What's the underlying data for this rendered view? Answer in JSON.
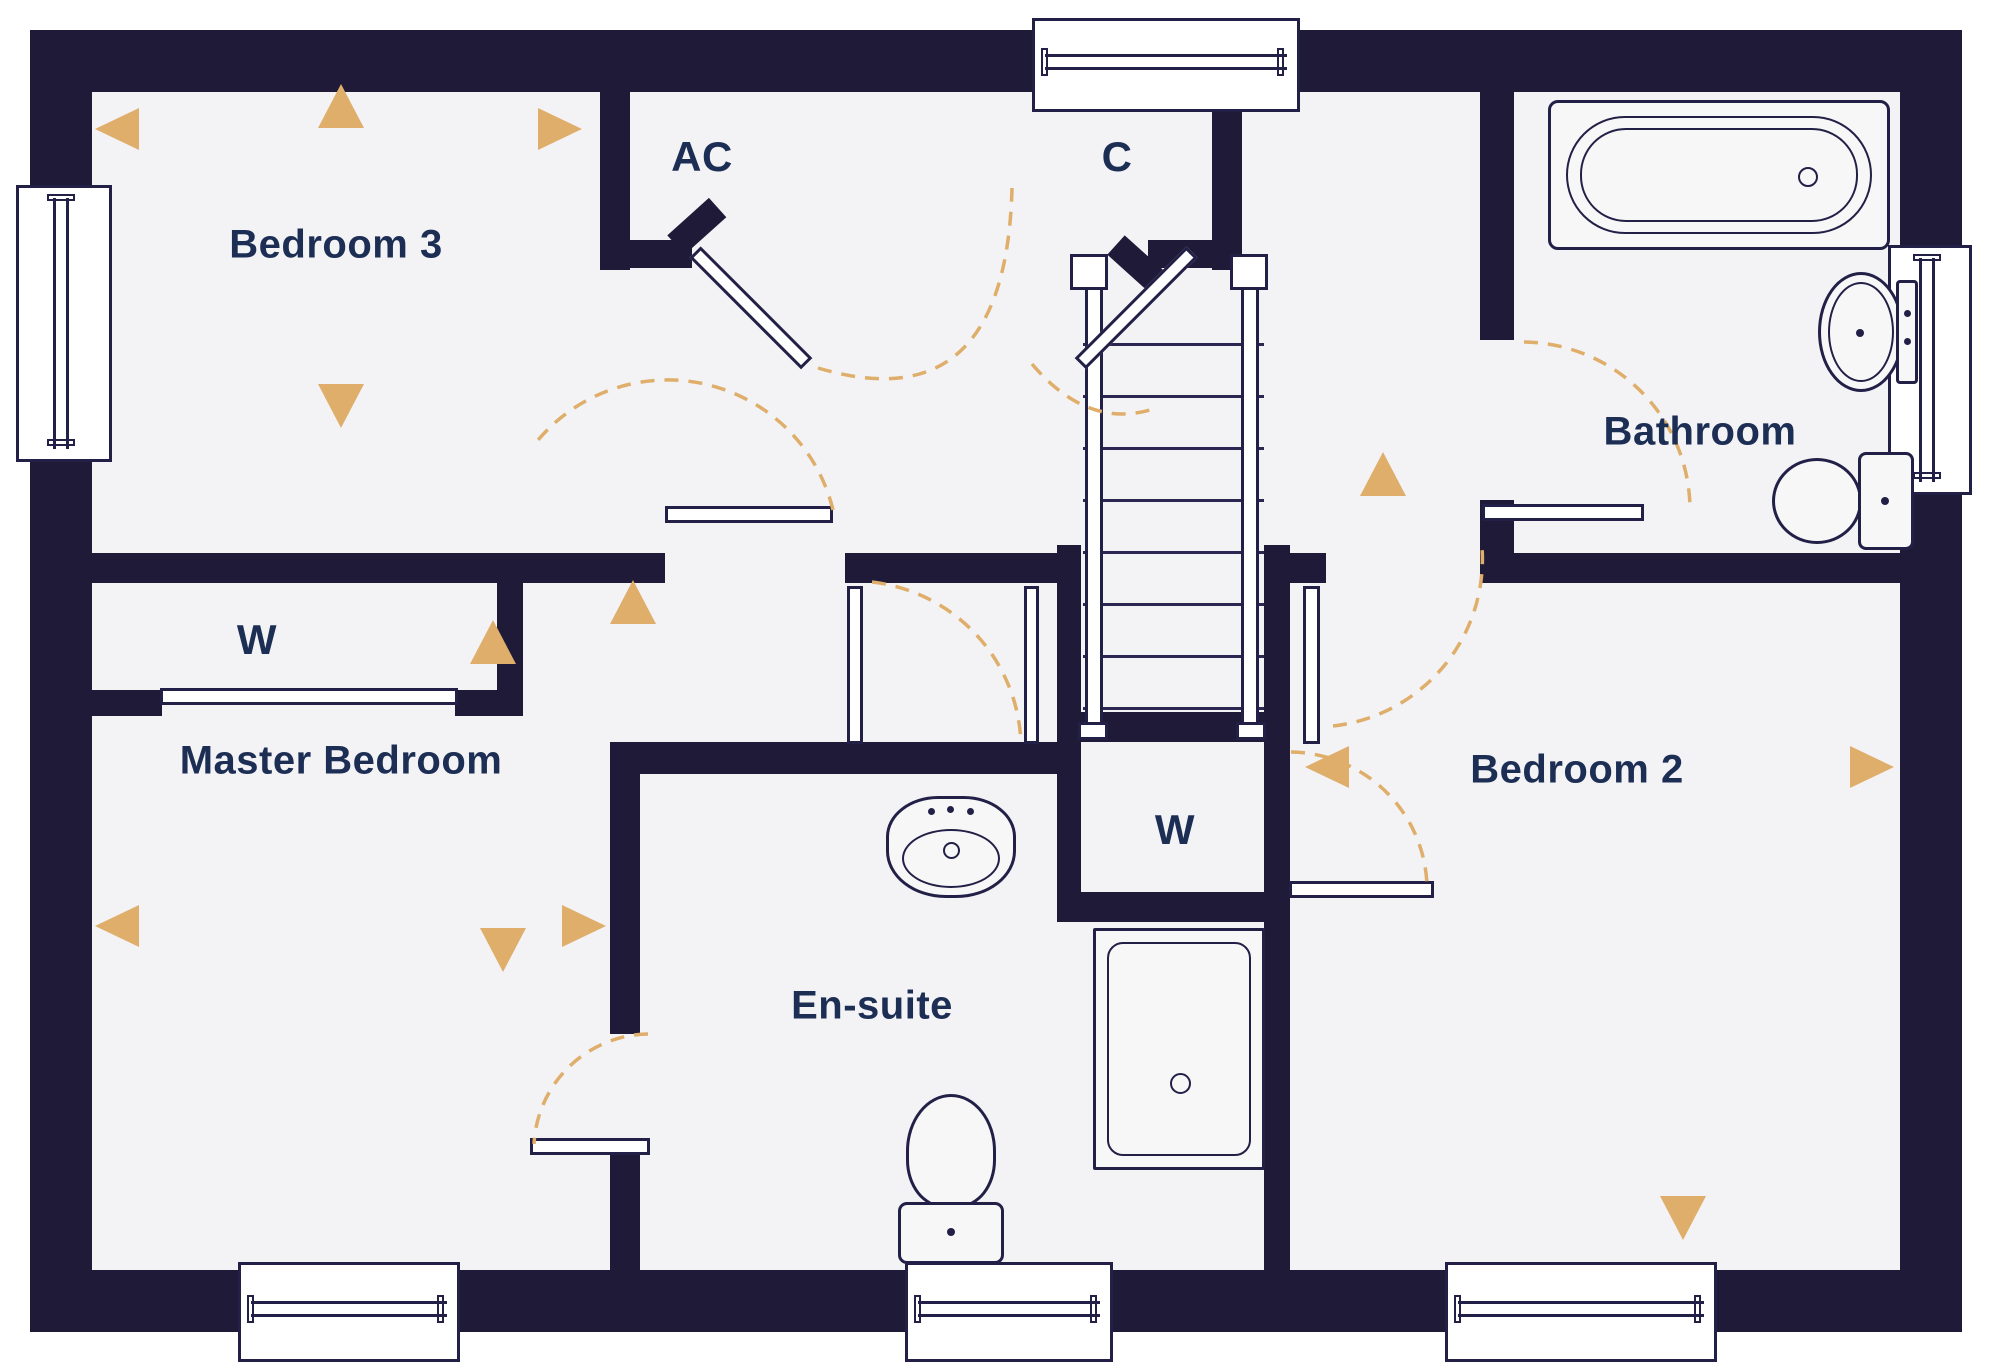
{
  "colors": {
    "wall": "#1e1a38",
    "floor": "#f3f3f5",
    "outline": "#232047",
    "accent_gold": "#dfae6b",
    "label_text": "#1d2e55",
    "background": "#ffffff"
  },
  "canvas": {
    "width": 2000,
    "height": 1369
  },
  "rooms": [
    {
      "id": "bedroom-3",
      "label": "Bedroom 3",
      "cx": 336,
      "cy": 245
    },
    {
      "id": "airing-cupboard",
      "label": "AC",
      "cx": 702,
      "cy": 157
    },
    {
      "id": "cupboard",
      "label": "C",
      "cx": 1117,
      "cy": 157
    },
    {
      "id": "bathroom",
      "label": "Bathroom",
      "cx": 1700,
      "cy": 432
    },
    {
      "id": "wardrobe-master",
      "label": "W",
      "cx": 257,
      "cy": 640
    },
    {
      "id": "master-bedroom",
      "label": "Master Bedroom",
      "cx": 341,
      "cy": 761
    },
    {
      "id": "en-suite",
      "label": "En-suite",
      "cx": 872,
      "cy": 1006
    },
    {
      "id": "wardrobe-bed2",
      "label": "W",
      "cx": 1175,
      "cy": 830
    },
    {
      "id": "bedroom-2",
      "label": "Bedroom 2",
      "cx": 1577,
      "cy": 770
    }
  ],
  "floor_rect": [
    60,
    60,
    1880,
    1250
  ],
  "walls": [
    [
      30,
      30,
      1932,
      62
    ],
    [
      30,
      1270,
      1932,
      62
    ],
    [
      30,
      30,
      62,
      1302
    ],
    [
      1900,
      30,
      62,
      1302
    ],
    [
      600,
      92,
      30,
      178
    ],
    [
      600,
      240,
      92,
      28
    ],
    [
      1212,
      92,
      30,
      178
    ],
    [
      1148,
      240,
      94,
      28
    ],
    [
      92,
      553,
      573,
      30
    ],
    [
      845,
      553,
      236,
      30
    ],
    [
      1264,
      553,
      62,
      30
    ],
    [
      1480,
      553,
      420,
      30
    ],
    [
      497,
      553,
      26,
      163
    ],
    [
      92,
      690,
      70,
      26
    ],
    [
      455,
      690,
      68,
      26
    ],
    [
      610,
      742,
      471,
      32
    ],
    [
      610,
      742,
      30,
      292
    ],
    [
      610,
      1148,
      30,
      122
    ],
    [
      1057,
      545,
      24,
      377
    ],
    [
      1057,
      712,
      231,
      30
    ],
    [
      1057,
      892,
      232,
      30
    ],
    [
      1264,
      545,
      26,
      725
    ],
    [
      1480,
      92,
      34,
      248
    ],
    [
      1480,
      500,
      34,
      83
    ]
  ],
  "angled_stubs": [
    {
      "x": 676,
      "y": 232,
      "w": 56,
      "h": 26,
      "rot": -42
    },
    {
      "x": 1116,
      "y": 232,
      "w": 56,
      "h": 26,
      "rot": 42
    }
  ],
  "windows": [
    {
      "name": "landing-window",
      "x": 1032,
      "y": 18,
      "w": 268,
      "h": 94,
      "orient": "h"
    },
    {
      "name": "bedroom3-window",
      "x": 16,
      "y": 185,
      "w": 96,
      "h": 277,
      "orient": "v"
    },
    {
      "name": "bathroom-window",
      "x": 1888,
      "y": 245,
      "w": 84,
      "h": 250,
      "orient": "v"
    },
    {
      "name": "master-window",
      "x": 238,
      "y": 1262,
      "w": 222,
      "h": 100,
      "orient": "h"
    },
    {
      "name": "ensuite-window",
      "x": 905,
      "y": 1262,
      "w": 208,
      "h": 100,
      "orient": "h"
    },
    {
      "name": "bedroom2-window",
      "x": 1445,
      "y": 1262,
      "w": 272,
      "h": 100,
      "orient": "h"
    }
  ],
  "door_leaves": [
    {
      "name": "bedroom3-door-leaf",
      "x": 665,
      "y": 506,
      "w": 168,
      "h": 17
    },
    {
      "name": "master-door-leaf",
      "x": 847,
      "y": 586,
      "w": 16,
      "h": 158
    },
    {
      "name": "landing-jamb",
      "x": 1024,
      "y": 586,
      "w": 15,
      "h": 158
    },
    {
      "name": "bedroom2-door-leaf",
      "x": 1303,
      "y": 586,
      "w": 17,
      "h": 158
    },
    {
      "name": "bathroom-door-leaf",
      "x": 1482,
      "y": 504,
      "w": 162,
      "h": 17
    },
    {
      "name": "ensuite-door-leaf",
      "x": 530,
      "y": 1138,
      "w": 120,
      "h": 17
    },
    {
      "name": "wardrobe-master-slider",
      "x": 160,
      "y": 688,
      "w": 298,
      "h": 17
    },
    {
      "name": "wardrobe-bed2-door-leaf",
      "x": 1289,
      "y": 881,
      "w": 145,
      "h": 17
    },
    {
      "name": "ac-door-leaf",
      "x": 695,
      "y": 244,
      "w": 158,
      "h": 16,
      "rot": 45,
      "origin": "left center"
    },
    {
      "name": "c-door-leaf",
      "x": 1034,
      "y": 244,
      "w": 158,
      "h": 16,
      "rot": -45,
      "origin": "right center"
    }
  ],
  "door_arcs": [
    {
      "name": "ac-door-arc",
      "d": "M 818 368 Q 1006 424 1012 188"
    },
    {
      "name": "c-door-arc",
      "d": "M 1032 364 Q 1086 428 1150 410"
    },
    {
      "name": "bedroom3-door-arc",
      "d": "M 833 510 A 170 170 0 0 0 534 445"
    },
    {
      "name": "master-door-arc",
      "d": "M 872 582 A 168 168 0 0 1 1021 744"
    },
    {
      "name": "bedroom2-door-arc",
      "d": "M 1333 726 A 168 168 0 0 0 1482 547"
    },
    {
      "name": "bathroom-door-arc",
      "d": "M 1524 342 A 168 168 0 0 1 1690 508"
    },
    {
      "name": "ensuite-door-arc",
      "d": "M 648 1034 A 116 116 0 0 0 534 1144"
    },
    {
      "name": "wardrobe-bed2-door-arc",
      "d": "M 1291 752 A 138 138 0 0 1 1427 886"
    }
  ],
  "arrows": [
    {
      "dir": "up",
      "x": 318,
      "y": 84
    },
    {
      "dir": "left",
      "x": 95,
      "y": 108
    },
    {
      "dir": "right",
      "x": 538,
      "y": 108
    },
    {
      "dir": "down",
      "x": 318,
      "y": 384
    },
    {
      "dir": "up",
      "x": 470,
      "y": 620
    },
    {
      "dir": "up",
      "x": 610,
      "y": 580
    },
    {
      "dir": "up",
      "x": 1360,
      "y": 452
    },
    {
      "dir": "left",
      "x": 95,
      "y": 905
    },
    {
      "dir": "down",
      "x": 480,
      "y": 928
    },
    {
      "dir": "right",
      "x": 562,
      "y": 905
    },
    {
      "dir": "left",
      "x": 1305,
      "y": 746
    },
    {
      "dir": "right",
      "x": 1850,
      "y": 746
    },
    {
      "dir": "down",
      "x": 1660,
      "y": 1196
    }
  ],
  "stairs": {
    "tread_x": 1083,
    "tread_w": 181,
    "tread_ys": [
      343,
      395,
      447,
      499,
      551,
      603,
      655,
      707
    ],
    "rails": [
      [
        1085,
        270,
        18,
        468
      ],
      [
        1241,
        270,
        18,
        468
      ]
    ],
    "newels": [
      [
        1070,
        254,
        38,
        36
      ],
      [
        1230,
        254,
        38,
        36
      ]
    ],
    "caps": [
      [
        1078,
        722,
        30,
        18
      ],
      [
        1236,
        722,
        30,
        18
      ]
    ]
  },
  "fixtures": [
    {
      "type": "bathtub",
      "name": "bathtub",
      "x": 1548,
      "y": 100,
      "w": 342,
      "h": 150
    },
    {
      "type": "sink-side",
      "name": "bathroom-sink",
      "x": 1818,
      "y": 268,
      "w": 100,
      "h": 128
    },
    {
      "type": "toilet-side",
      "name": "bathroom-toilet",
      "x": 1772,
      "y": 452,
      "w": 142,
      "h": 98
    },
    {
      "type": "sink-top",
      "name": "ensuite-sink",
      "x": 886,
      "y": 796,
      "w": 130,
      "h": 102
    },
    {
      "type": "toilet-up",
      "name": "ensuite-toilet",
      "x": 898,
      "y": 1094,
      "w": 106,
      "h": 170
    },
    {
      "type": "shower",
      "name": "shower-tray",
      "x": 1093,
      "y": 928,
      "w": 172,
      "h": 242
    }
  ]
}
